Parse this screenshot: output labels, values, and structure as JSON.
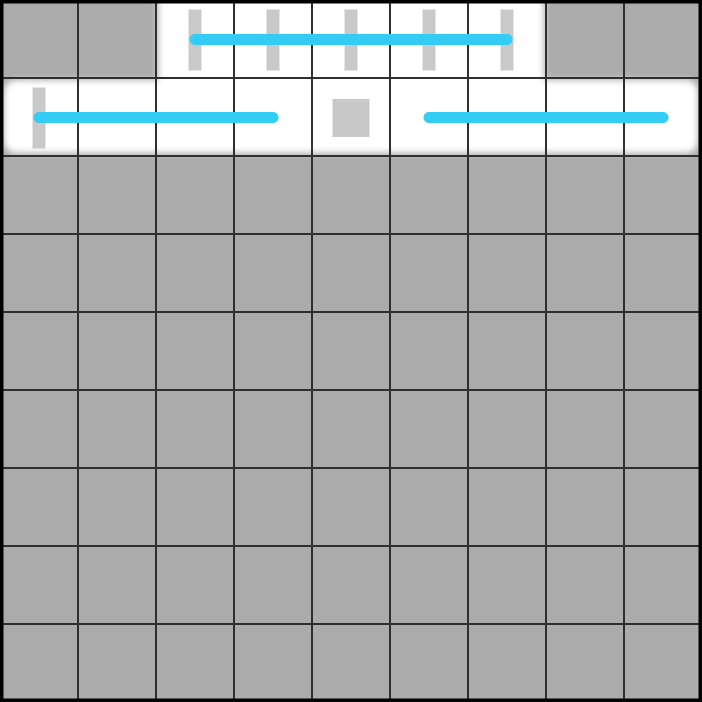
{
  "board": {
    "grid": {
      "rows": 9,
      "cols": 9,
      "cell_size": 78,
      "width": 702,
      "height": 702
    },
    "colors": {
      "cell_gray": "#ababab",
      "highlight_white": "#ffffff",
      "grid_line": "#2f2f2f",
      "outer_border": "#000000",
      "placeholder_gray": "#c9c9c9",
      "square_gray": "#c8c8c8",
      "strike_cyan": "#33ccf5"
    },
    "style": {
      "grid_line_width": 2,
      "outer_border_width": 7,
      "highlight_blur": 3.5,
      "tick_width": 13,
      "tick_height": 61,
      "square_width": 37,
      "square_height": 38,
      "strike_thickness": 11
    },
    "highlight_regions": [
      {
        "name": "top-word-slot",
        "row": 0,
        "col_start": 2,
        "col_end": 6
      },
      {
        "name": "second-row-slot",
        "row": 1,
        "col_start": 0,
        "col_end": 8
      }
    ],
    "tick_marks": [
      {
        "row": 0,
        "col": 2
      },
      {
        "row": 0,
        "col": 3
      },
      {
        "row": 0,
        "col": 4
      },
      {
        "row": 0,
        "col": 5
      },
      {
        "row": 0,
        "col": 6
      },
      {
        "row": 1,
        "col": 0
      }
    ],
    "square_marks": [
      {
        "row": 1,
        "col": 4
      }
    ],
    "strike_lines": [
      {
        "row": 0,
        "col_start": 2,
        "col_end": 6
      },
      {
        "row": 1,
        "col_start": 0,
        "col_end": 3
      },
      {
        "row": 1,
        "col_start": 5,
        "col_end": 8
      }
    ]
  }
}
